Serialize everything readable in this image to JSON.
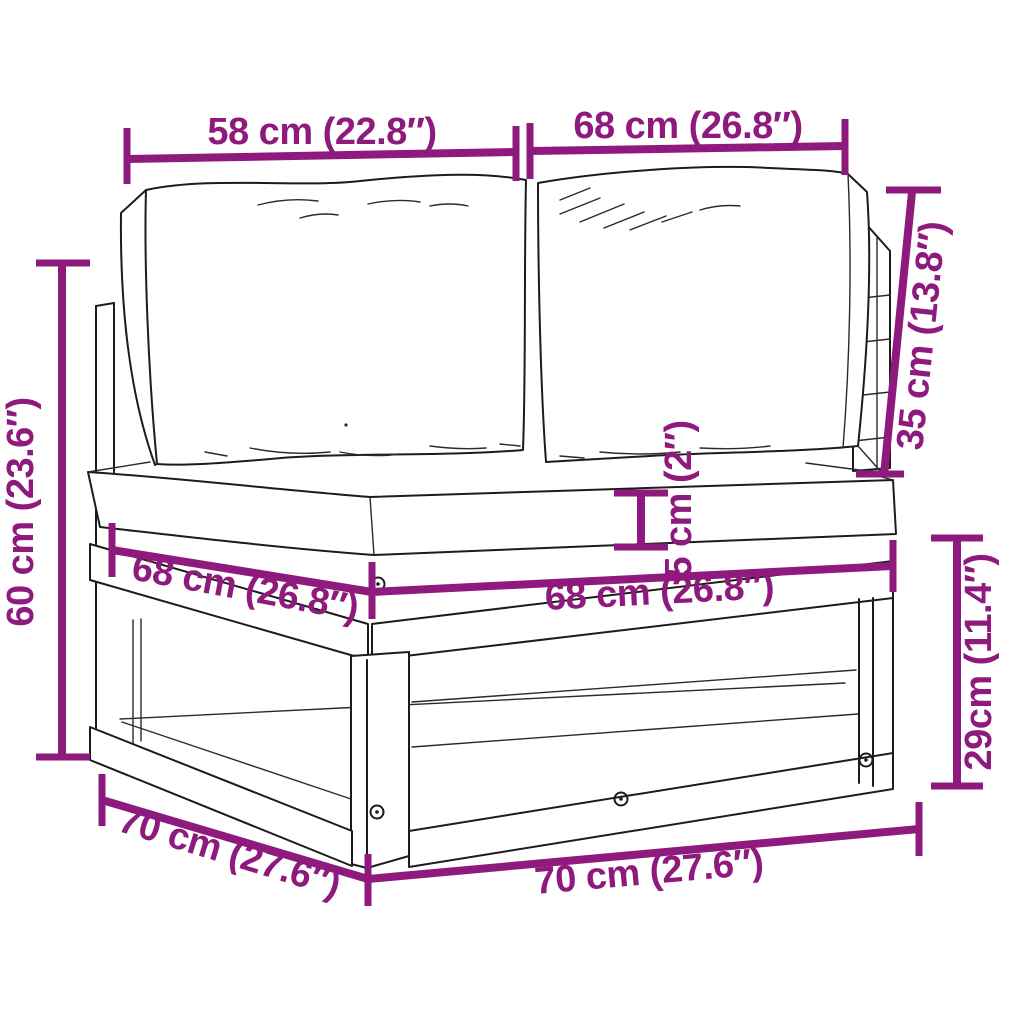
{
  "image_type": "product dimension diagram",
  "product": "wooden pallet corner sofa with back cushions and seat cushion",
  "colors": {
    "accent": "#8E1A7D",
    "line_art": "#1c1c1c",
    "background": "#ffffff"
  },
  "dims": {
    "backrest_left_width": {
      "label": "58 cm (22.8″)"
    },
    "backrest_right_width": {
      "label": "68 cm (26.8″)"
    },
    "backrest_height": {
      "label": "35 cm (13.8″)"
    },
    "overall_height": {
      "label": "60 cm (23.6″)"
    },
    "seat_cushion_thickness": {
      "label": "5 cm (2″)"
    },
    "seat_left_width": {
      "label": "68 cm (26.8″)"
    },
    "seat_right_width": {
      "label": "68 cm (26.8″)"
    },
    "base_height": {
      "label": "29cm (11.4″)"
    },
    "base_depth": {
      "label": "70 cm (27.6″)"
    },
    "base_width": {
      "label": "70 cm (27.6″)"
    }
  }
}
